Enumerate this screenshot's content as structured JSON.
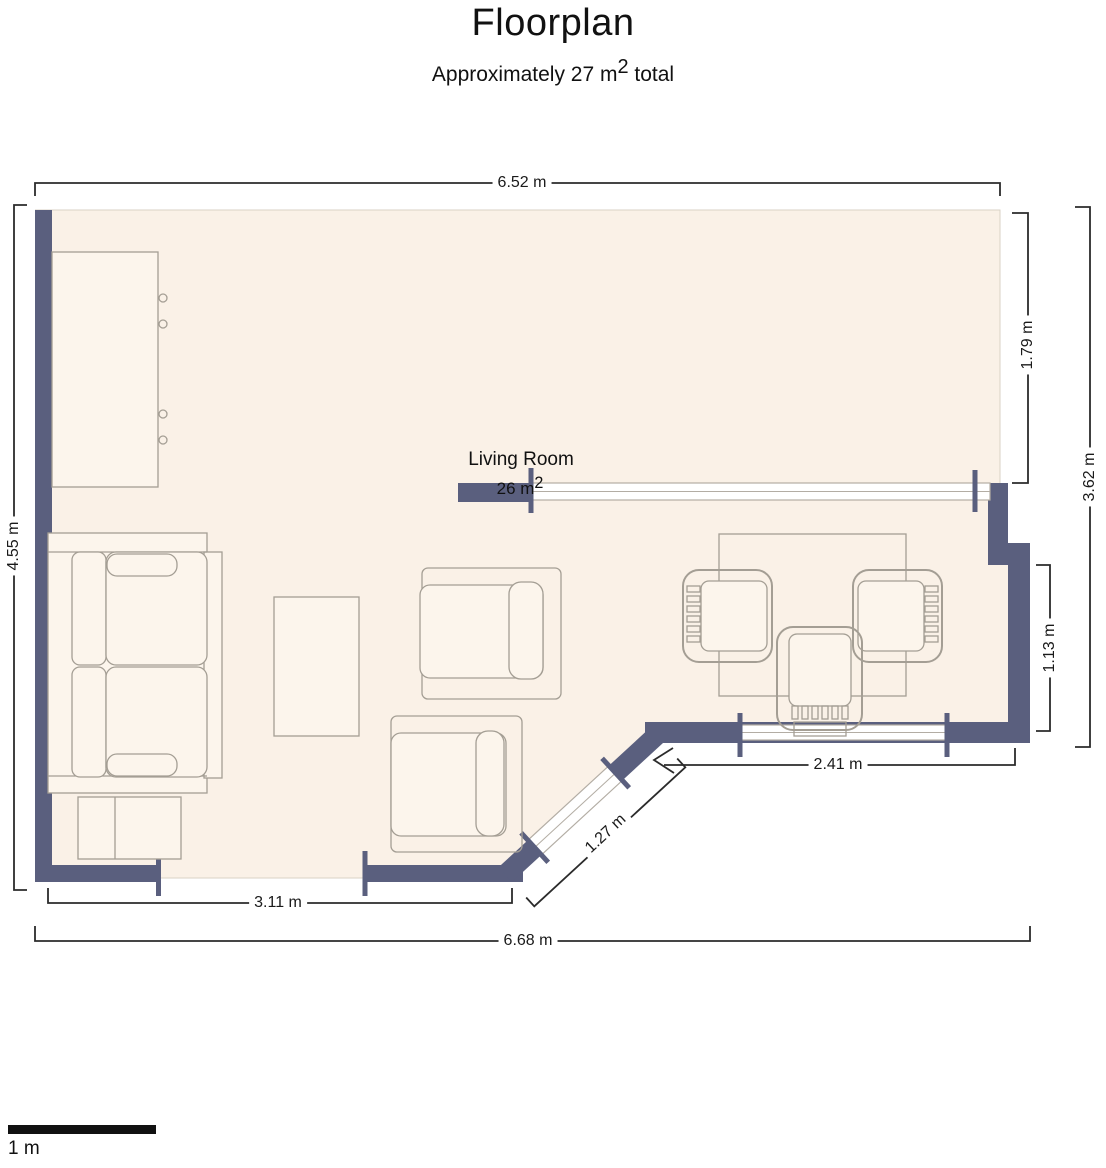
{
  "header": {
    "title": "Floorplan",
    "subtitle_prefix": "Approximately 27 m",
    "subtitle_sup": "2",
    "subtitle_suffix": " total"
  },
  "room": {
    "name": "Living Room",
    "area_prefix": "26 m",
    "area_sup": "2"
  },
  "dimensions": {
    "top_width": "6.52 m",
    "left_height": "4.55 m",
    "right_upper": "1.79 m",
    "right_total": "3.62 m",
    "right_lower": "1.13 m",
    "bottom_left_inner": "3.11 m",
    "bottom_total": "6.68 m",
    "dining_width": "2.41 m",
    "diagonal": "1.27 m"
  },
  "scale_bar": {
    "label": "1 m"
  },
  "colors": {
    "wall": "#5a5f7e",
    "floor": "#faf1e7",
    "window_frame": "#b3ada4",
    "furniture_outline": "#a49e94",
    "dimension": "#2b2b2b",
    "text": "#111111"
  }
}
